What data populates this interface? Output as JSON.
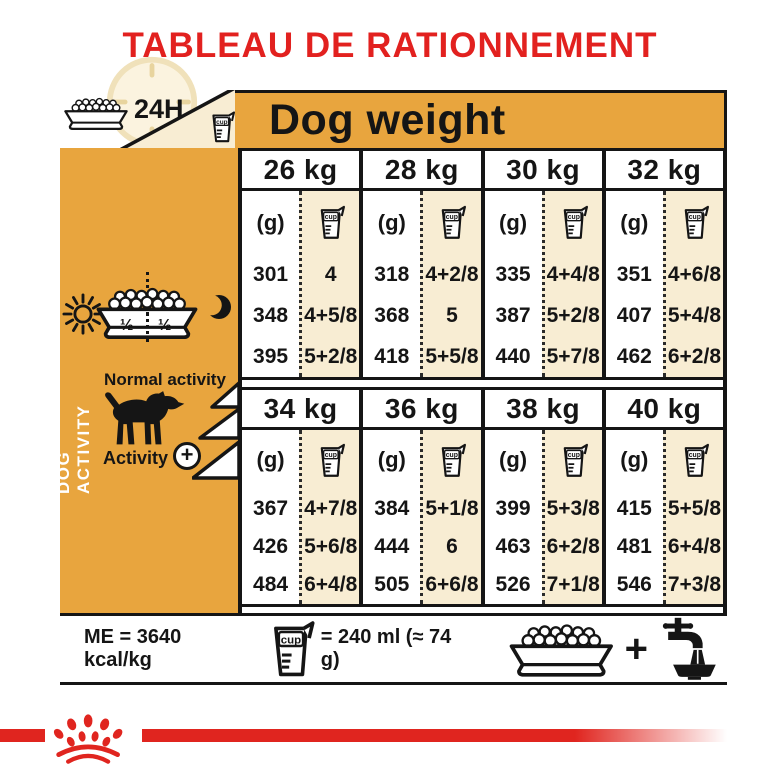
{
  "title": "TABLEAU DE RATIONNEMENT",
  "colors": {
    "brand_red": "#E2211F",
    "gold": "#E8A53E",
    "cream": "#F8EDD3",
    "ink": "#151515"
  },
  "header": {
    "daily_label": "24H",
    "table_title": "Dog weight"
  },
  "icons": {
    "cup_label": "cup"
  },
  "sidebar": {
    "axis_label": "DOG ACTIVITY",
    "half_left": "½",
    "half_right": "½",
    "normal_activity": "Normal activity",
    "activity": "Activity",
    "plus": "+"
  },
  "chart_data": {
    "type": "table",
    "title": "Dog weight",
    "unit_g": "(g)",
    "unit_cup": "cup",
    "sections": [
      {
        "columns": [
          {
            "weight": "26 kg",
            "rows": [
              {
                "g": "301",
                "cups": "4"
              },
              {
                "g": "348",
                "cups": "4+5/8"
              },
              {
                "g": "395",
                "cups": "5+2/8"
              }
            ]
          },
          {
            "weight": "28 kg",
            "rows": [
              {
                "g": "318",
                "cups": "4+2/8"
              },
              {
                "g": "368",
                "cups": "5"
              },
              {
                "g": "418",
                "cups": "5+5/8"
              }
            ]
          },
          {
            "weight": "30 kg",
            "rows": [
              {
                "g": "335",
                "cups": "4+4/8"
              },
              {
                "g": "387",
                "cups": "5+2/8"
              },
              {
                "g": "440",
                "cups": "5+7/8"
              }
            ]
          },
          {
            "weight": "32 kg",
            "rows": [
              {
                "g": "351",
                "cups": "4+6/8"
              },
              {
                "g": "407",
                "cups": "5+4/8"
              },
              {
                "g": "462",
                "cups": "6+2/8"
              }
            ]
          }
        ]
      },
      {
        "columns": [
          {
            "weight": "34 kg",
            "rows": [
              {
                "g": "367",
                "cups": "4+7/8"
              },
              {
                "g": "426",
                "cups": "5+6/8"
              },
              {
                "g": "484",
                "cups": "6+4/8"
              }
            ]
          },
          {
            "weight": "36 kg",
            "rows": [
              {
                "g": "384",
                "cups": "5+1/8"
              },
              {
                "g": "444",
                "cups": "6"
              },
              {
                "g": "505",
                "cups": "6+6/8"
              }
            ]
          },
          {
            "weight": "38 kg",
            "rows": [
              {
                "g": "399",
                "cups": "5+3/8"
              },
              {
                "g": "463",
                "cups": "6+2/8"
              },
              {
                "g": "526",
                "cups": "7+1/8"
              }
            ]
          },
          {
            "weight": "40 kg",
            "rows": [
              {
                "g": "415",
                "cups": "5+5/8"
              },
              {
                "g": "481",
                "cups": "6+4/8"
              },
              {
                "g": "546",
                "cups": "7+3/8"
              }
            ]
          }
        ]
      }
    ]
  },
  "footer": {
    "me": "ME = 3640 kcal/kg",
    "cup_equiv": "= 240 ml (≈ 74 g)",
    "plus": "+"
  }
}
